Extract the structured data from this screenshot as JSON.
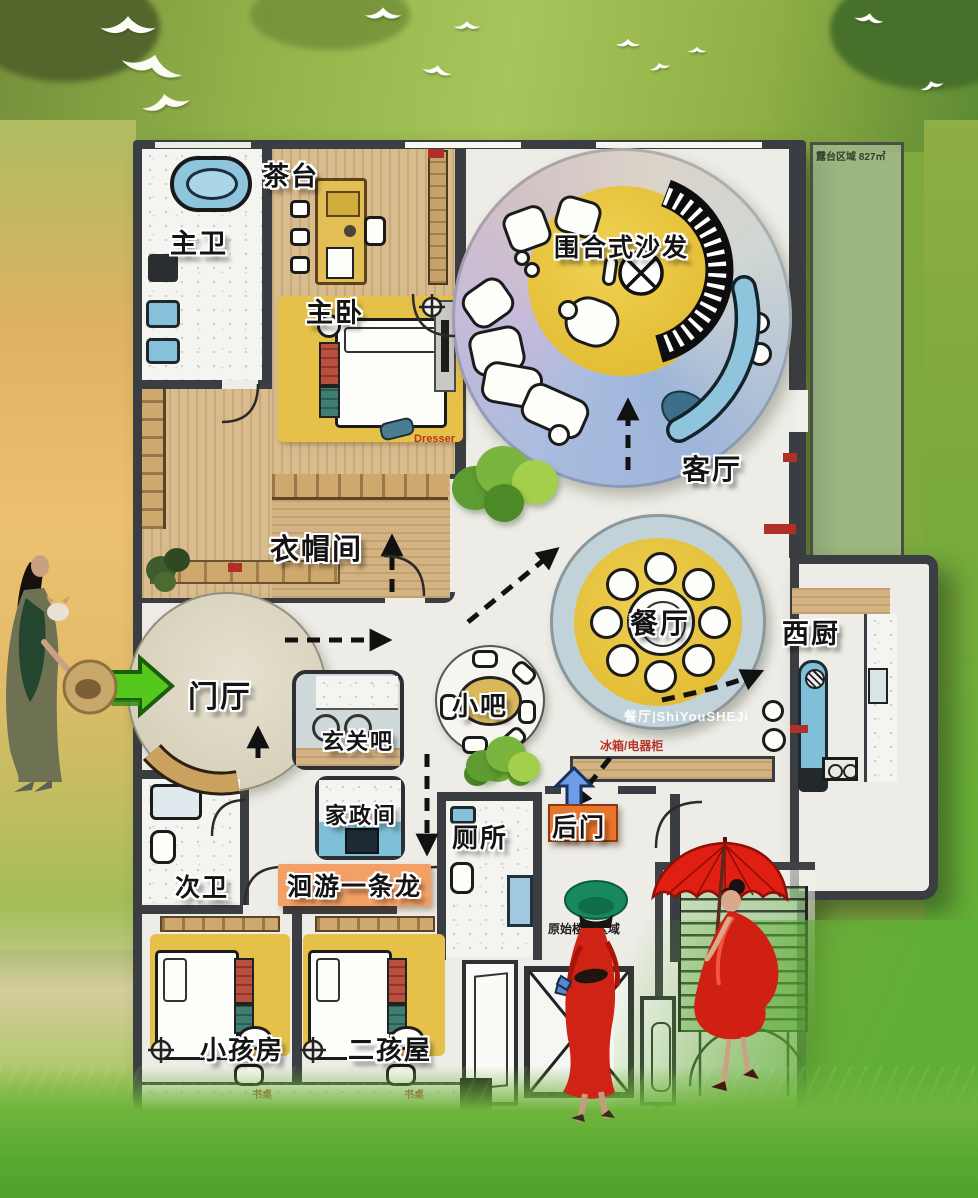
{
  "rooms": {
    "tea_table": {
      "label": "茶台"
    },
    "master_bath": {
      "label": "主卫"
    },
    "master_bedroom": {
      "label": "主卧"
    },
    "sofa_circle": {
      "label": "围合式沙发"
    },
    "living_room": {
      "label": "客厅"
    },
    "cloakroom": {
      "label": "衣帽间"
    },
    "foyer": {
      "label": "门厅"
    },
    "entry_bar": {
      "label": "玄关吧"
    },
    "small_bar": {
      "label": "小吧"
    },
    "dining": {
      "label": "餐厅"
    },
    "west_kitchen": {
      "label": "西厨"
    },
    "housekeeping": {
      "label": "家政间"
    },
    "second_bath": {
      "label": "次卫"
    },
    "loop_path": {
      "label": "洄游一条龙"
    },
    "toilet": {
      "label": "厕所"
    },
    "back_door": {
      "label": "后门"
    },
    "kid_room_1": {
      "label": "小孩房"
    },
    "kid_room_2": {
      "label": "二孩屋"
    }
  },
  "annotations": {
    "terrace": "露台区域 827㎡",
    "watermark": "餐厅|ShiYouSHEJi",
    "fridge_cabinet": "冰箱/电器柜",
    "dresser": "Dresser",
    "desk": "书桌",
    "stair_area": "原始楼梯区域"
  },
  "figures": {
    "left": "woman-with-straw-hat-and-cat",
    "middle": "woman-in-green-hat-red-dress",
    "right": "woman-with-red-umbrella"
  },
  "icons": {
    "entry_arrow": "green-entry-arrow",
    "backdoor_arrow": "blue-backdoor-arrow",
    "route_arrow": "dashed-route-arrow",
    "compass": "compass-target-icon",
    "bird": "crane-bird-icon",
    "tree": "tree-canopy-icon"
  },
  "colors": {
    "wall": "#3A3D41",
    "accent_yellow": "#E6C23D",
    "pool_blue": "#86C0DA",
    "ring_blue": "#C1D3D9",
    "lavender_blue": "#A9BCDF",
    "loop_highlight": "#F2A066",
    "back_door_orange": "#E9742B",
    "entry_arrow_green": "#55C81E",
    "dress_red": "#CE2315",
    "grass_green": "#5FAE35"
  }
}
